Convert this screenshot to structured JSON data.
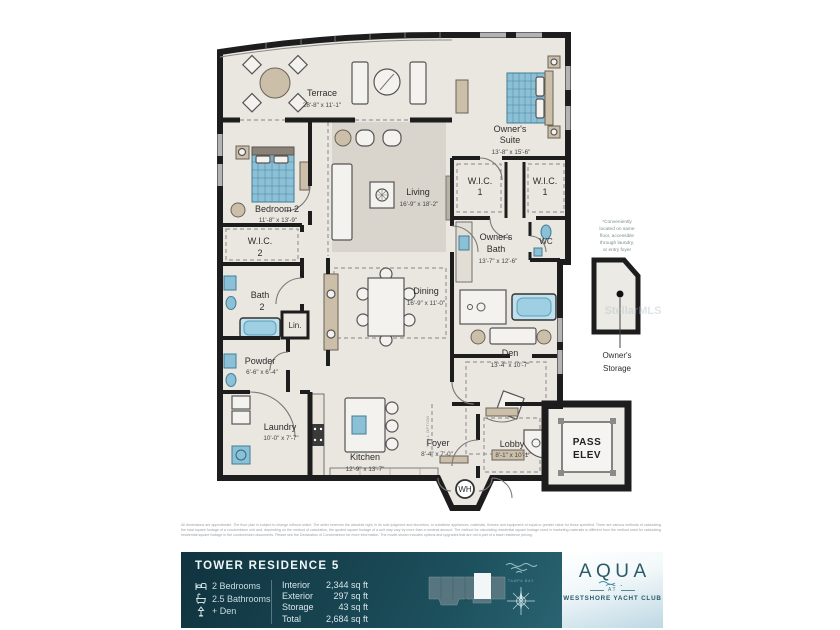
{
  "plan": {
    "watermark": "StellarMLS",
    "wall_option": "WALL OPTION",
    "wh": "WH",
    "note_lines": [
      "*Conveniently",
      "located on same",
      "floor, accessible",
      "through laundry,",
      "or entry foyer"
    ],
    "rooms": {
      "terrace": {
        "name": "Terrace",
        "dims": "28'-8\" x 11'-1\""
      },
      "owners_suite": {
        "line1": "Owner's",
        "line2": "Suite",
        "dims": "13'-8\" x 15'-6\""
      },
      "bedroom2": {
        "name": "Bedroom 2",
        "dims": "11'-8\" x 13'-9\""
      },
      "living": {
        "name": "Living",
        "dims": "16'-9\" x 18'-2\""
      },
      "wic1_left": {
        "line1": "W.I.C.",
        "line2": "1"
      },
      "wic1_right": {
        "line1": "W.I.C.",
        "line2": "1"
      },
      "wic2": {
        "line1": "W.I.C.",
        "line2": "2"
      },
      "owners_bath": {
        "line1": "Owner's",
        "line2": "Bath",
        "dims": "13'-7\" x 12'-6\""
      },
      "wc": {
        "name": "WC"
      },
      "bath2": {
        "line1": "Bath",
        "line2": "2"
      },
      "dining": {
        "name": "Dining",
        "dims": "16'-9\" x 11'-0\""
      },
      "linen": {
        "name": "Lin."
      },
      "powder": {
        "name": "Powder",
        "dims": "6'-6\" x 6'-4\""
      },
      "den": {
        "name": "Den",
        "dims": "13'-4\" x 10'-7\""
      },
      "laundry": {
        "name": "Laundry",
        "dims": "10'-0\" x 7'-7\""
      },
      "kitchen": {
        "name": "Kitchen",
        "dims": "12'-9\" x 13'-7\""
      },
      "foyer": {
        "name": "Foyer",
        "dims": "8'-4\" x 7'-0\""
      },
      "lobby": {
        "name": "Lobby",
        "dims": "8'-1\" x 10'-1\""
      },
      "pass_elev": {
        "line1": "PASS",
        "line2": "ELEV"
      },
      "owners_storage": {
        "line1": "Owner's",
        "line2": "Storage"
      }
    }
  },
  "disclaimer": "All dimensions are approximate. The floor plan is subject to change without notice. The seller reserves the absolute right, in its sole judgment and discretion, to substitute appliances, materials, fixtures and equipment of equal or greater value for those specified. There are various methods of calculating the total square footage of a condominium unit and, depending on the method of calculation, the quoted square footage of a unit may vary by more than a nominal amount. The method for calculating residential square footage used in marketing materials is different from the method used for calculating residential square footage in the condominium documents. Please see the Declaration of Condominium for more information. The model shown includes options and upgrades that are not a part of a base residence pricing.",
  "footer": {
    "title": "TOWER RESIDENCE 5",
    "features": [
      {
        "icon": "bed-icon",
        "label": "2 Bedrooms"
      },
      {
        "icon": "bath-icon",
        "label": "2.5 Bathrooms"
      },
      {
        "icon": "lamp-icon",
        "label": "+ Den"
      }
    ],
    "areas": [
      {
        "label": "Interior",
        "value": "2,344 sq ft"
      },
      {
        "label": "Exterior",
        "value": "297 sq ft"
      },
      {
        "label": "Storage",
        "value": "43 sq ft"
      },
      {
        "label": "Total",
        "value": "2,684 sq ft"
      }
    ],
    "bay_caption": "TAMPA BAY",
    "compass_north": "N",
    "logo": {
      "name": "AQUA",
      "at": "AT",
      "club": "WESTSHORE YACHT CLUB"
    }
  },
  "colors": {
    "footer_teal": "#17434f",
    "logo_teal": "#2a5b68",
    "accent_blue": "#8cc0d6",
    "wall_black": "#1d1d1d"
  }
}
